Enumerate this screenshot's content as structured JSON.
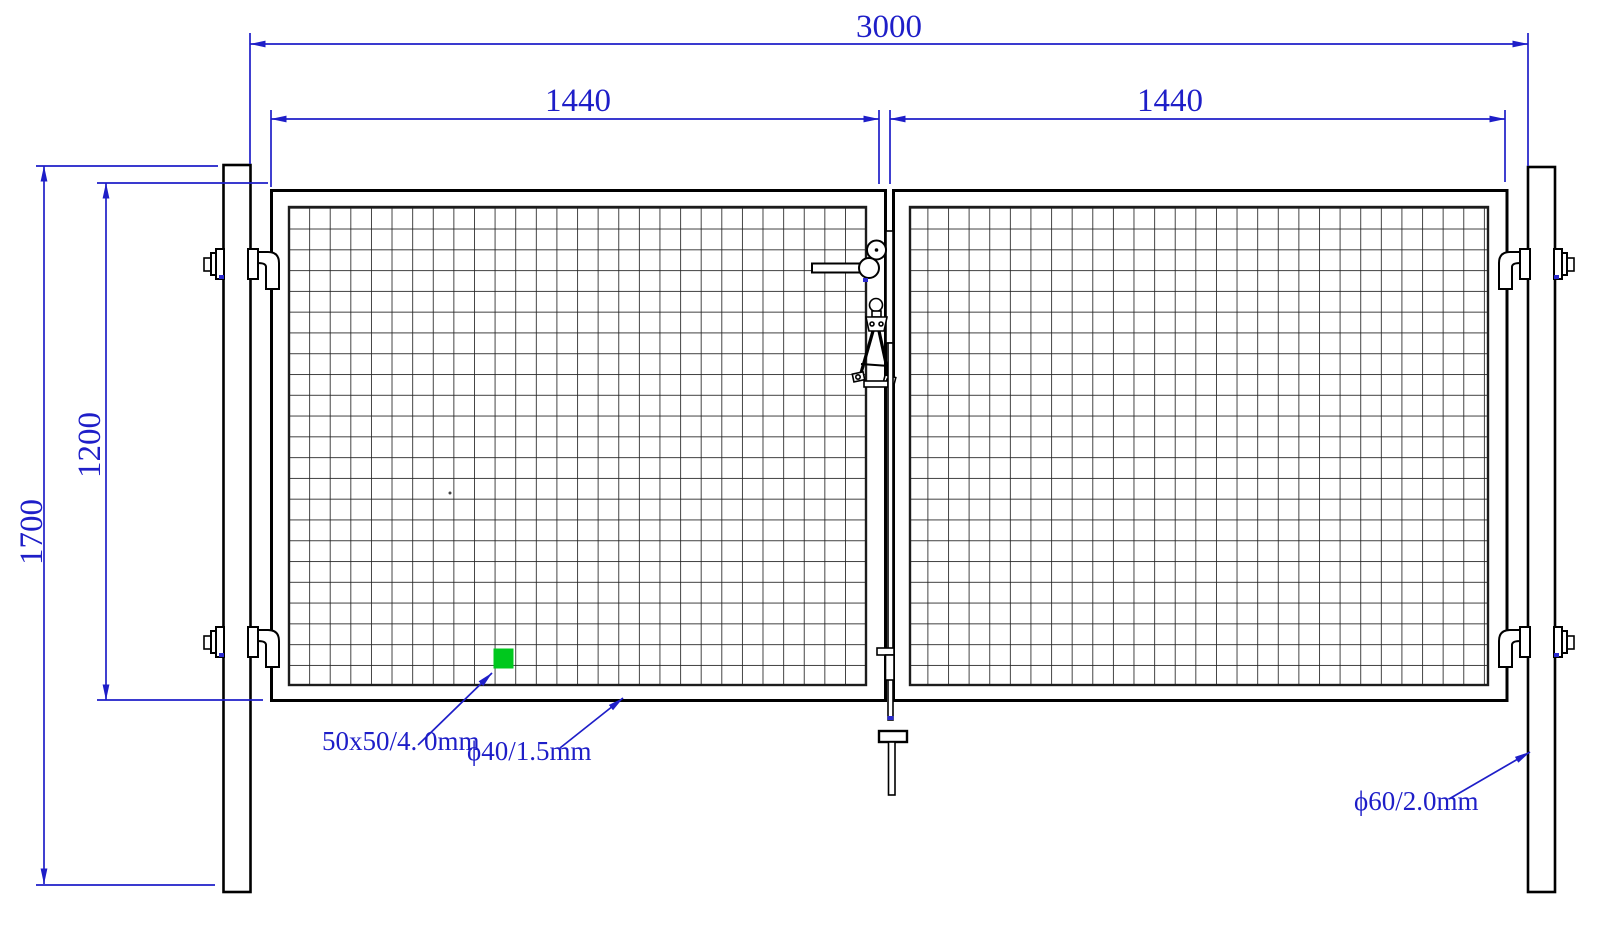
{
  "drawing": {
    "type": "technical-drawing",
    "subject": "double-leaf-wire-mesh-gate-front-elevation",
    "colors": {
      "dimension_blue": "#1e1ec8",
      "line_black": "#000000",
      "mesh_highlight_green": "#00c81e",
      "background": "#ffffff"
    },
    "dimensions": {
      "overall_width": "3000",
      "left_leaf_width": "1440",
      "right_leaf_width": "1440",
      "post_height": "1700",
      "leaf_height": "1200"
    },
    "annotations": {
      "mesh_spec": {
        "label": "50x50/4. 0mm"
      },
      "frame_spec": {
        "label": "ϕ40/1.5mm"
      },
      "post_spec": {
        "label": "ϕ60/2.0mm"
      }
    }
  }
}
